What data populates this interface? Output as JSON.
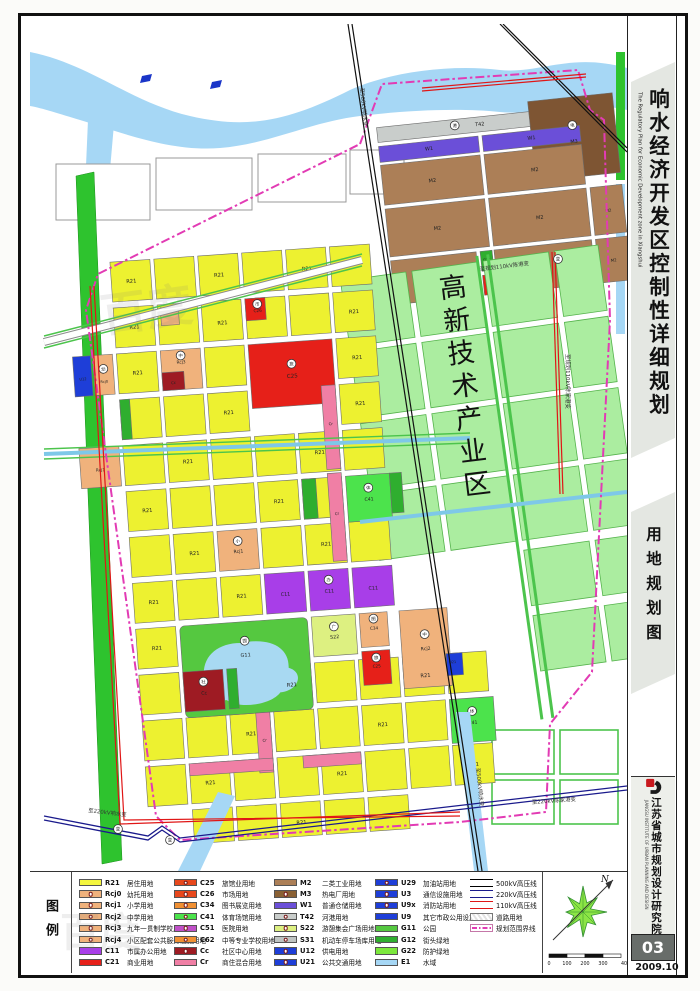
{
  "page": {
    "sheet_no": "03",
    "date": "2009.10"
  },
  "sidebar": {
    "title_cn": "响水经济开发区控制性详细规划",
    "title_en": "The Regulatory Plan for Economic Development zone in Xiangshui",
    "subtitle": "用地规划图",
    "institute_cn": "江苏省城市规划设计研究院",
    "institute_en": "JIANGSU INSTITUTE OF URBAN PLANNING AND DESIGN"
  },
  "map": {
    "zone_label": "高新技术产业区",
    "annotations": [
      {
        "t": "至500kV响水变",
        "x": 330,
        "y": 64,
        "r": 84
      },
      {
        "t": "至500kV响水变",
        "x": 446,
        "y": 744,
        "r": 84
      },
      {
        "t": "至220kV响水变",
        "x": 58,
        "y": 788,
        "r": 7
      },
      {
        "t": "至220kV陈家港变",
        "x": 502,
        "y": 780,
        "r": -4
      },
      {
        "t": "至规划110kV陈家港变",
        "x": 536,
        "y": 330,
        "r": 90
      },
      {
        "t": "至规划110kV陈港变",
        "x": 450,
        "y": 247,
        "r": -7
      }
    ],
    "parcel_labels": [
      {
        "g": "res",
        "x": 120,
        "y": 249,
        "t": "R21"
      },
      {
        "g": "res",
        "x": 208,
        "y": 249,
        "t": "R21"
      },
      {
        "g": "res",
        "x": 296,
        "y": 249,
        "t": "R21"
      },
      {
        "g": "res",
        "x": 120,
        "y": 295,
        "t": "R21"
      },
      {
        "g": "res",
        "x": 208,
        "y": 297,
        "t": "R21"
      },
      {
        "g": "res",
        "x": 340,
        "y": 295,
        "t": "R21"
      },
      {
        "g": "res",
        "x": 120,
        "y": 341,
        "t": "R21"
      },
      {
        "g": "res",
        "x": 340,
        "y": 341,
        "t": "R21"
      },
      {
        "g": "res",
        "x": 208,
        "y": 387,
        "t": "R21"
      },
      {
        "g": "res",
        "x": 340,
        "y": 387,
        "t": "R21"
      },
      {
        "g": "res",
        "x": 164,
        "y": 433,
        "t": "R21"
      },
      {
        "g": "res",
        "x": 296,
        "y": 433,
        "t": "R21"
      },
      {
        "g": "res",
        "x": 120,
        "y": 479,
        "t": "R21"
      },
      {
        "g": "res",
        "x": 252,
        "y": 479,
        "t": "R21"
      },
      {
        "g": "res",
        "x": 164,
        "y": 525,
        "t": "R21"
      },
      {
        "g": "res",
        "x": 296,
        "y": 525,
        "t": "R21"
      },
      {
        "g": "res",
        "x": 120,
        "y": 571,
        "t": "R21"
      },
      {
        "g": "res",
        "x": 208,
        "y": 571,
        "t": "R21"
      },
      {
        "g": "res",
        "x": 120,
        "y": 617,
        "t": "R21"
      },
      {
        "g": "res",
        "x": 252,
        "y": 663,
        "t": "R21"
      },
      {
        "g": "res",
        "x": 386,
        "y": 663,
        "t": "R21"
      },
      {
        "g": "res",
        "x": 208,
        "y": 709,
        "t": "R21"
      },
      {
        "g": "res",
        "x": 340,
        "y": 709,
        "t": "R21"
      },
      {
        "g": "res",
        "x": 164,
        "y": 755,
        "t": "R21"
      },
      {
        "g": "res",
        "x": 296,
        "y": 755,
        "t": "R21"
      },
      {
        "g": "res",
        "x": 428,
        "y": 755,
        "t": "R21"
      },
      {
        "g": "res",
        "x": 252,
        "y": 801,
        "t": "R21"
      },
      {
        "g": "res",
        "x": 244,
        "y": 287,
        "t": "C26",
        "s": 4.2
      },
      {
        "g": "res",
        "x": 274,
        "y": 355,
        "t": "C25",
        "s": 5.5
      },
      {
        "g": "res",
        "x": 164,
        "y": 333,
        "t": "Rcj3",
        "s": 4.2
      },
      {
        "g": "res",
        "x": 155,
        "y": 353,
        "t": "Cc",
        "s": 3.8
      },
      {
        "g": "res",
        "x": 86,
        "y": 347,
        "t": "Rcj0",
        "s": 3.6
      },
      {
        "g": "res",
        "x": 65,
        "y": 343,
        "t": "U12",
        "s": 3.6
      },
      {
        "g": "res",
        "x": 76,
        "y": 435,
        "t": "Rcj1",
        "s": 4.2
      },
      {
        "g": "res",
        "x": 208,
        "y": 526,
        "t": "Rcj1",
        "s": 4.6
      },
      {
        "g": "res",
        "x": 252,
        "y": 572,
        "t": "C11",
        "s": 4.8
      },
      {
        "g": "res",
        "x": 296,
        "y": 572,
        "t": "C11",
        "s": 4.8
      },
      {
        "g": "res",
        "x": 340,
        "y": 572,
        "t": "C11",
        "s": 4.8
      },
      {
        "g": "res",
        "x": 298,
        "y": 618,
        "t": "S22",
        "s": 4.8
      },
      {
        "g": "res",
        "x": 208,
        "y": 630,
        "t": "G11",
        "s": 5
      },
      {
        "g": "res",
        "x": 338,
        "y": 612,
        "t": "C34",
        "s": 4.2
      },
      {
        "g": "res",
        "x": 338,
        "y": 650,
        "t": "C25",
        "s": 4.2
      },
      {
        "g": "res",
        "x": 388,
        "y": 636,
        "t": "Rcj2",
        "s": 4.6
      },
      {
        "g": "res",
        "x": 164,
        "y": 665,
        "t": "Cc",
        "s": 4.8
      },
      {
        "g": "res",
        "x": 342,
        "y": 483,
        "t": "C41",
        "s": 4.6
      },
      {
        "g": "res",
        "x": 430,
        "y": 713,
        "t": "C41",
        "s": 4.6
      },
      {
        "g": "res",
        "x": 309,
        "y": 405,
        "t": "Cr",
        "s": 3.8
      },
      {
        "g": "res",
        "x": 309,
        "y": 495,
        "t": "Cr",
        "s": 3.8
      },
      {
        "g": "res",
        "x": 221,
        "y": 716,
        "t": "Cr",
        "s": 3.8
      },
      {
        "g": "res",
        "x": 414,
        "y": 651,
        "t": "U21",
        "s": 3.6
      },
      {
        "g": "ind",
        "x": 455,
        "y": 101,
        "t": "T42",
        "s": 5
      },
      {
        "g": "ind",
        "x": 402,
        "y": 120,
        "t": "W1",
        "s": 5
      },
      {
        "g": "ind",
        "x": 505,
        "y": 120,
        "t": "W1",
        "s": 5
      },
      {
        "g": "ind",
        "x": 402,
        "y": 152,
        "t": "M2",
        "s": 5
      },
      {
        "g": "ind",
        "x": 505,
        "y": 152,
        "t": "M2",
        "s": 5
      },
      {
        "g": "ind",
        "x": 402,
        "y": 200,
        "t": "M2",
        "s": 5
      },
      {
        "g": "ind",
        "x": 505,
        "y": 200,
        "t": "M2",
        "s": 5
      },
      {
        "g": "ind",
        "x": 399,
        "y": 250,
        "t": "M2",
        "s": 5
      },
      {
        "g": "ind",
        "x": 505,
        "y": 250,
        "t": "M2",
        "s": 5
      },
      {
        "g": "ind",
        "x": 547,
        "y": 128,
        "t": "M3",
        "s": 5
      },
      {
        "g": "ind",
        "x": 574,
        "y": 200,
        "t": "M2",
        "s": 4
      },
      {
        "g": "ind",
        "x": 574,
        "y": 250,
        "t": "M2",
        "s": 4
      },
      {
        "g": "ind",
        "x": 448,
        "y": 263,
        "t": "C21",
        "s": 3.6
      },
      {
        "g": "ind",
        "x": 448,
        "y": 236,
        "t": "G12",
        "s": 3.6
      }
    ],
    "symbols": [
      {
        "g": "res",
        "x": 164,
        "y": 325,
        "t": "中"
      },
      {
        "g": "res",
        "x": 208,
        "y": 514,
        "t": "小"
      },
      {
        "g": "res",
        "x": 296,
        "y": 559,
        "t": "办"
      },
      {
        "g": "res",
        "x": 298,
        "y": 606,
        "t": "广"
      },
      {
        "g": "res",
        "x": 338,
        "y": 601,
        "t": "图"
      },
      {
        "g": "res",
        "x": 338,
        "y": 640,
        "t": "旅"
      },
      {
        "g": "res",
        "x": 388,
        "y": 620,
        "t": "中"
      },
      {
        "g": "res",
        "x": 208,
        "y": 614,
        "t": "园"
      },
      {
        "g": "res",
        "x": 342,
        "y": 470,
        "t": "体"
      },
      {
        "g": "res",
        "x": 430,
        "y": 700,
        "t": "体"
      },
      {
        "g": "res",
        "x": 164,
        "y": 652,
        "t": "社"
      },
      {
        "g": "res",
        "x": 86,
        "y": 333,
        "t": "幼"
      },
      {
        "g": "res",
        "x": 274,
        "y": 341,
        "t": "旅"
      },
      {
        "g": "res",
        "x": 244,
        "y": 279,
        "t": "市"
      },
      {
        "g": "ind",
        "x": 547,
        "y": 110,
        "t": "电"
      },
      {
        "g": "ind",
        "x": 430,
        "y": 98,
        "t": "港"
      },
      {
        "g": "root",
        "x": 88,
        "y": 805,
        "t": "变"
      },
      {
        "g": "root",
        "x": 140,
        "y": 816,
        "t": "变"
      },
      {
        "g": "root",
        "x": 528,
        "y": 235,
        "t": "变"
      }
    ],
    "watermark": "百度"
  },
  "legend": {
    "title": "图例",
    "compass_label": "N",
    "scale_ticks": [
      "0",
      "100",
      "200",
      "300",
      "400M"
    ],
    "columns": [
      [
        {
          "code": "R21",
          "label": "居住用地",
          "color": "#F4F63F"
        },
        {
          "code": "Rcj0",
          "label": "幼托用地",
          "color": "#F0B27C",
          "sym": true
        },
        {
          "code": "Rcj1",
          "label": "小学用地",
          "color": "#F0B27C",
          "sym": true
        },
        {
          "code": "Rcj2",
          "label": "中学用地",
          "color": "#F0B27C",
          "sym": true
        },
        {
          "code": "Rcj3",
          "label": "九年一贯制学校用地",
          "color": "#F0B27C",
          "sym": true
        },
        {
          "code": "Rcj4",
          "label": "小区配套公共服务设施用地",
          "color": "#F0B27C",
          "sym": true
        },
        {
          "code": "C11",
          "label": "市属办公用地",
          "color": "#A83EE8"
        },
        {
          "code": "C21",
          "label": "商业用地",
          "color": "#E62019"
        }
      ],
      [
        {
          "code": "C25",
          "label": "旅馆业用地",
          "color": "#E8481C",
          "sym": true
        },
        {
          "code": "C26",
          "label": "市场用地",
          "color": "#E8481C",
          "sym": true
        },
        {
          "code": "C34",
          "label": "图书展览用地",
          "color": "#F09033",
          "sym": true
        },
        {
          "code": "C41",
          "label": "体育场馆用地",
          "color": "#4CE34C",
          "sym": true
        },
        {
          "code": "C51",
          "label": "医院用地",
          "color": "#C050C8",
          "sym": true
        },
        {
          "code": "C62",
          "label": "中等专业学校用地",
          "color": "#F09033",
          "sym": true
        },
        {
          "code": "Cc",
          "label": "社区中心用地",
          "color": "#9E1B23",
          "sym": true
        },
        {
          "code": "Cr",
          "label": "商住混合用地",
          "color": "#F07FA5"
        }
      ],
      [
        {
          "code": "M2",
          "label": "二类工业用地",
          "color": "#AC7F57"
        },
        {
          "code": "M3",
          "label": "热电厂用地",
          "color": "#8A6134",
          "sym": true
        },
        {
          "code": "W1",
          "label": "普通仓储用地",
          "color": "#6B4FD8"
        },
        {
          "code": "T42",
          "label": "河港用地",
          "color": "#C9CDCB",
          "sym": true
        },
        {
          "code": "S22",
          "label": "游憩集会广场用地",
          "color": "#DDF081",
          "sym": true
        },
        {
          "code": "S31",
          "label": "机动车停车场库用地",
          "color": "#BFC4C2",
          "sym": true
        },
        {
          "code": "U12",
          "label": "供电用地",
          "color": "#1E3ED8",
          "sym": true
        },
        {
          "code": "U21",
          "label": "公共交通用地",
          "color": "#1E3ED8",
          "sym": true
        }
      ],
      [
        {
          "code": "U29",
          "label": "加油站用地",
          "color": "#1E3ED8",
          "sym": true
        },
        {
          "code": "U3",
          "label": "通信设施用地",
          "color": "#1E3ED8",
          "sym": true
        },
        {
          "code": "U9x",
          "label": "消防站用地",
          "color": "#1E3ED8",
          "sym": true
        },
        {
          "code": "U9",
          "label": "其它市政公用设施用地",
          "color": "#1E3ED8"
        },
        {
          "code": "G11",
          "label": "公园",
          "color": "#55C840"
        },
        {
          "code": "G12",
          "label": "街头绿地",
          "color": "#2FAE2F"
        },
        {
          "code": "G22",
          "label": "防护绿地",
          "color": "#7CE83C"
        },
        {
          "code": "E1",
          "label": "水域",
          "color": "#A6D7F5"
        }
      ]
    ],
    "lines": [
      {
        "label": "500kV高压线",
        "style": "hv500"
      },
      {
        "label": "220kV高压线",
        "style": "hv220"
      },
      {
        "label": "110kV高压线",
        "style": "hv110"
      },
      {
        "label": "道路用地",
        "style": "roadsw"
      },
      {
        "label": "规划范围界线",
        "style": "boundarysw"
      }
    ]
  }
}
